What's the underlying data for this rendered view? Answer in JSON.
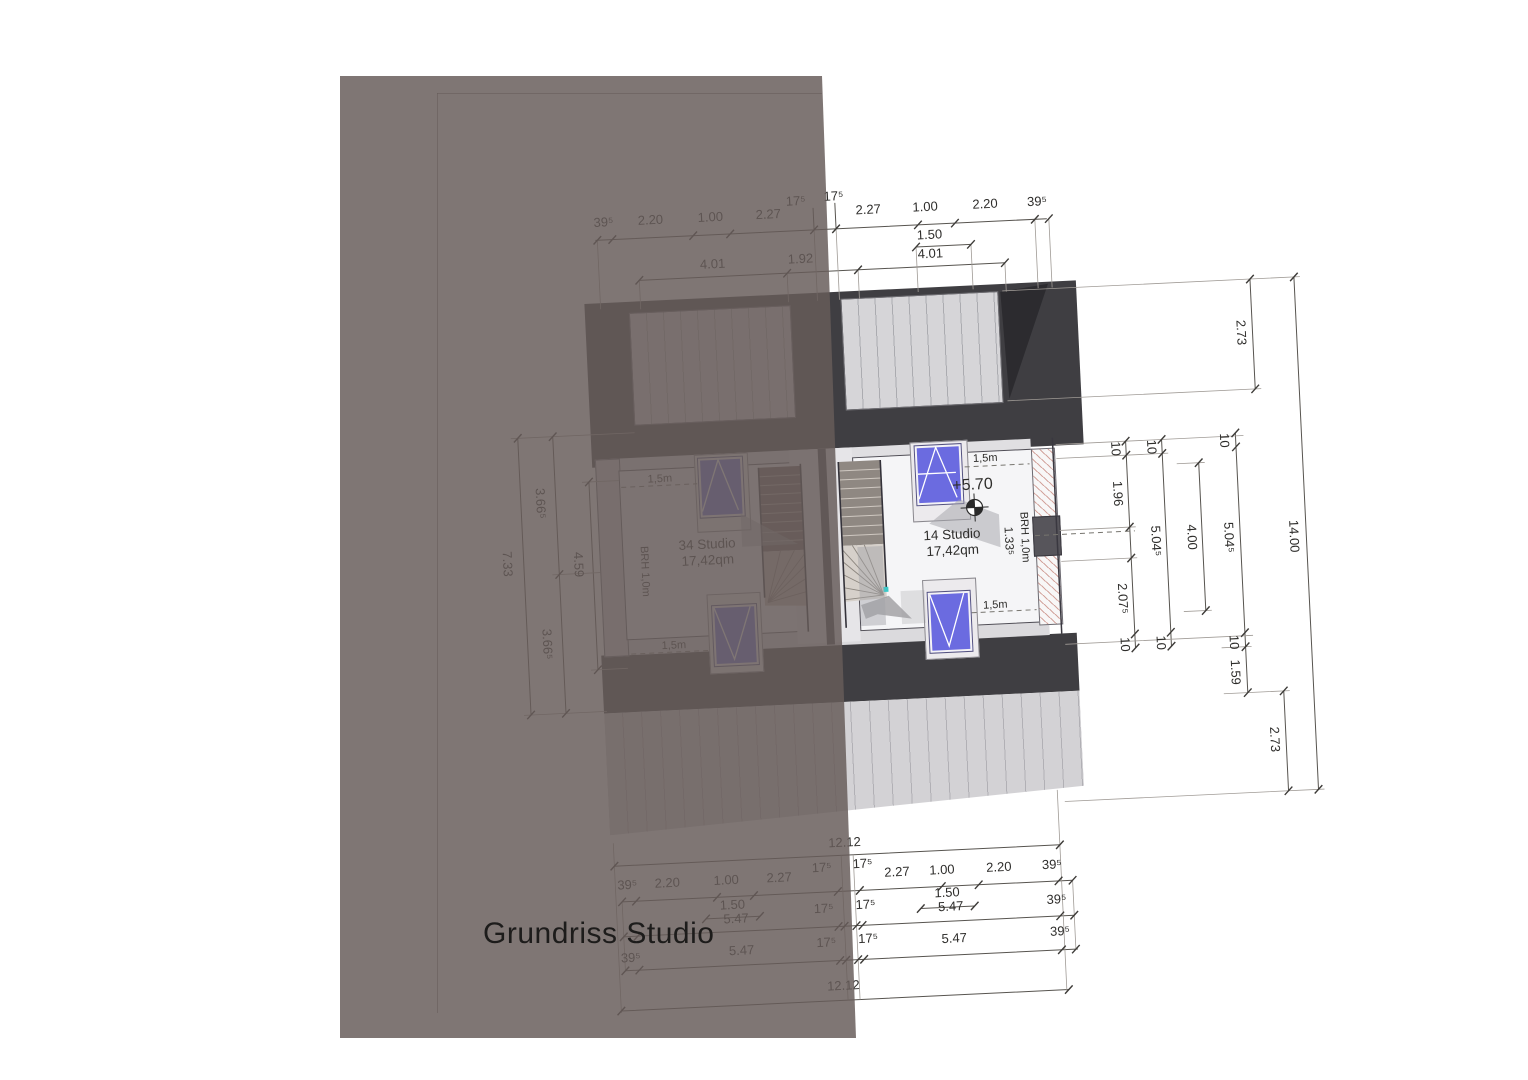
{
  "title": "Grundriss Studio",
  "rooms": {
    "left": {
      "name": "34 Studio",
      "area": "17,42qm",
      "sill_label": "BRH 1,0m",
      "headroom_top": "1,5m",
      "headroom_bottom": "1,5m"
    },
    "right": {
      "name": "14 Studio",
      "area": "17,42qm",
      "sill_label": "BRH 1,0m",
      "sill_height": "1.33⁵",
      "level": "+5.70",
      "headroom_top": "1,5m",
      "headroom_bottom": "1,5m"
    }
  },
  "dims": {
    "top": {
      "row1": [
        "39⁵",
        "2.20",
        "1.00",
        "2.27",
        "17⁵",
        "17⁵",
        "2.27",
        "1.00",
        "2.20",
        "39⁵"
      ],
      "row2": [
        "1.50"
      ],
      "row3": [
        "4.01",
        "1.92",
        "4.01"
      ]
    },
    "bottom": {
      "total_top": "12.12",
      "row1": [
        "39⁵",
        "2.20",
        "1.00",
        "2.27",
        "17⁵",
        "17⁵",
        "2.27",
        "1.00",
        "2.20",
        "39⁵"
      ],
      "row2": [
        "1.50",
        "1.50"
      ],
      "row3": [
        "5.47",
        "17⁵",
        "17⁵",
        "5.47",
        "39⁵"
      ],
      "row4": [
        "39⁵",
        "5.47",
        "17⁵",
        "17⁵",
        "5.47",
        "39⁵"
      ],
      "total_bottom": "12.12"
    },
    "left": {
      "total": "7.33",
      "halves": [
        "3.66⁵",
        "3.66⁵"
      ],
      "inner": "4.59"
    },
    "right": {
      "chain1": [
        "10",
        "1.96",
        "2.07⁵",
        "10"
      ],
      "chain2": [
        "10",
        "5.04⁵",
        "10"
      ],
      "chain3": [
        "4.00"
      ],
      "chain4": [
        "10",
        "5.04⁵",
        "10",
        "1.59"
      ],
      "top_gap": "2.73",
      "bottom_gap": "2.73",
      "total": "14.00"
    }
  },
  "colors": {
    "overlay": "#675c59",
    "roof_dark": "#3f3e42",
    "roof_light": "#d6d5d8",
    "skylight_blue": "#6b6be0",
    "hatch_pink": "#d3a49d",
    "accent_teal": "#3cc8c8",
    "room_floor": "#f5f5f7"
  }
}
